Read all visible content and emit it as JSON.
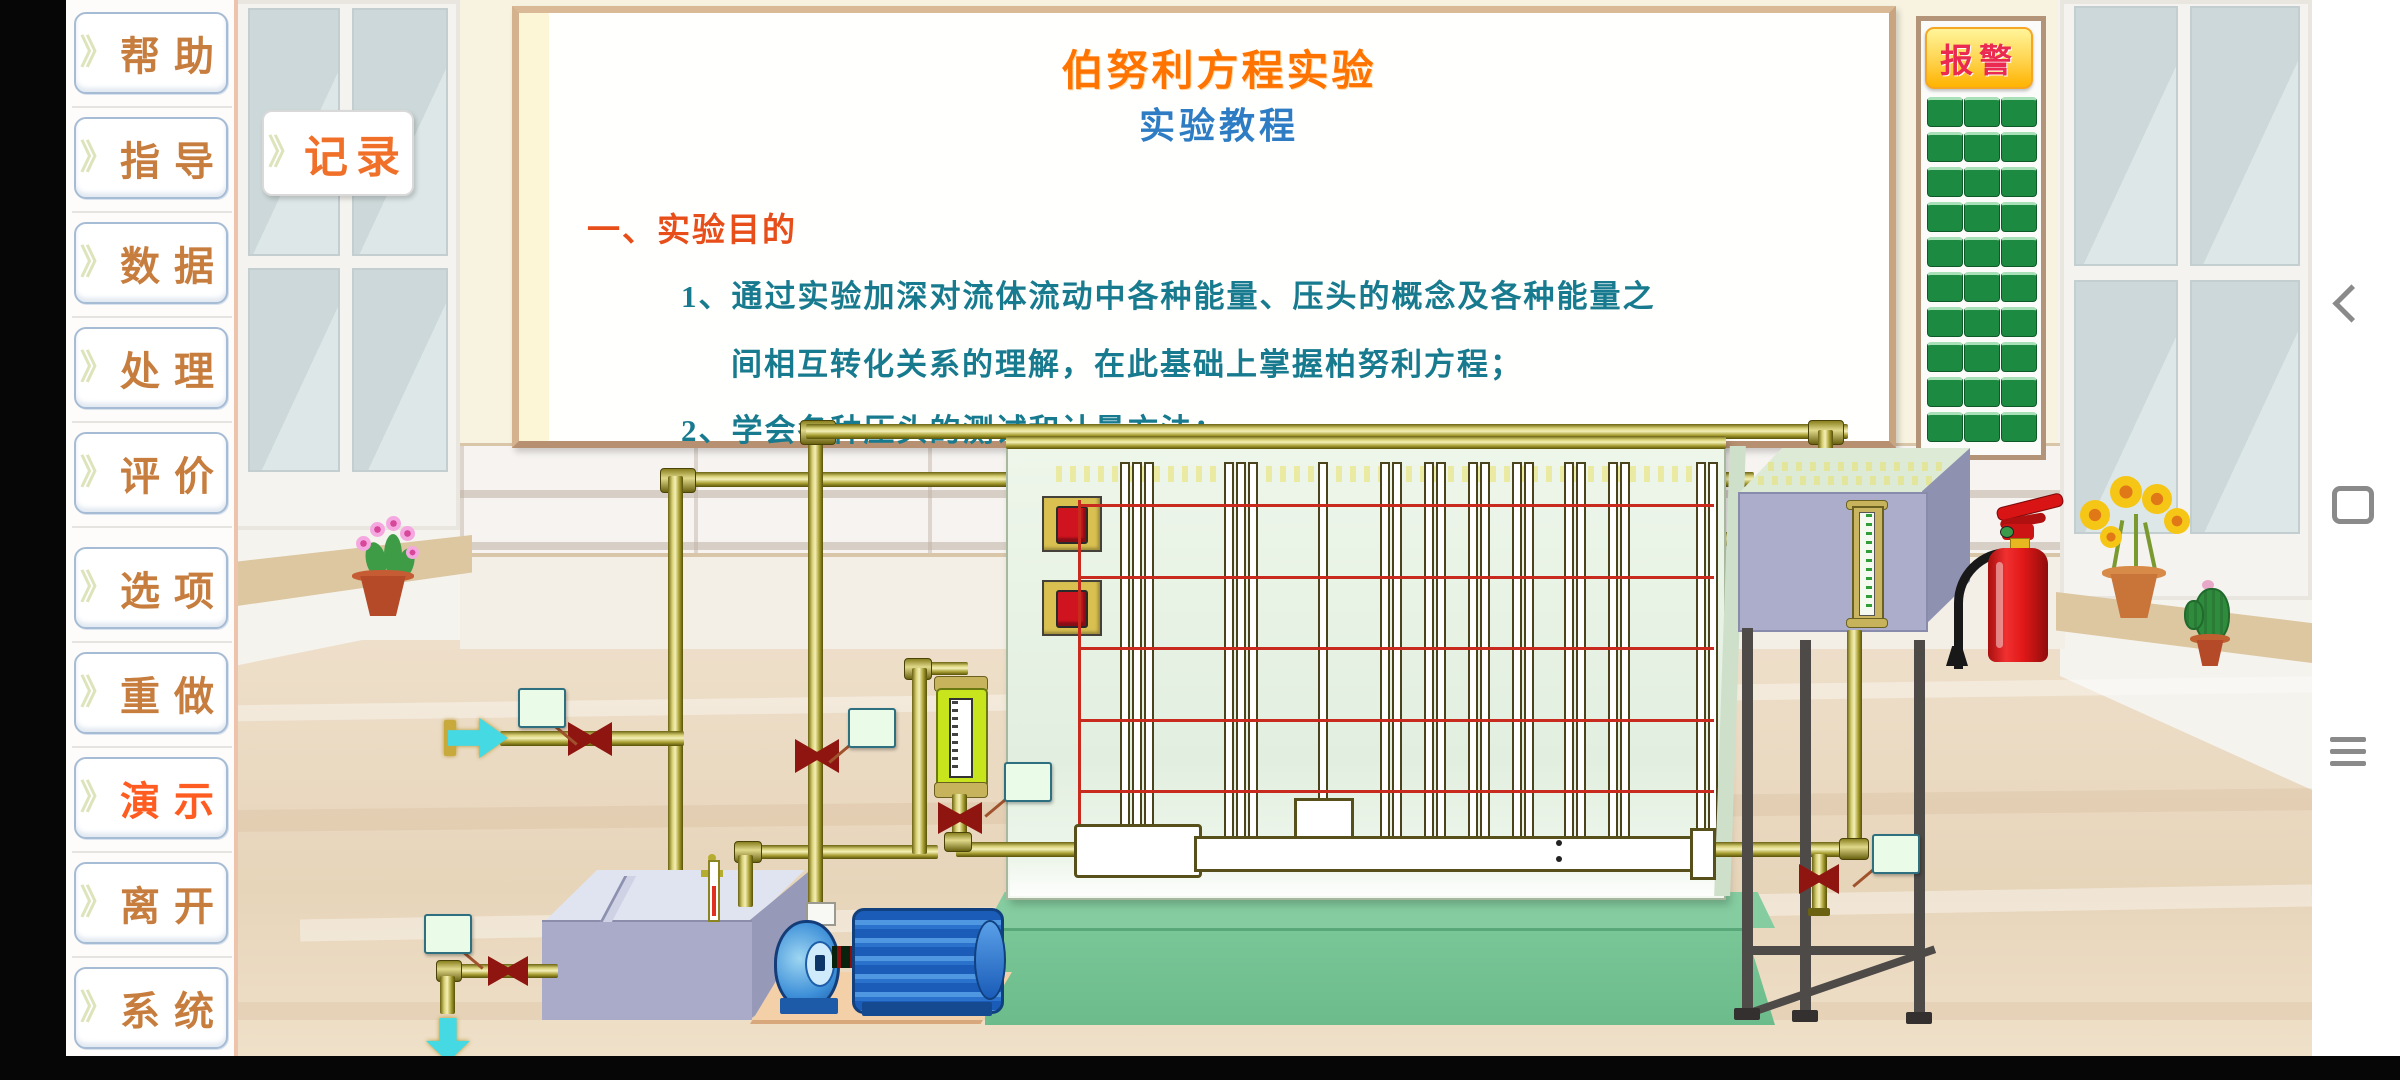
{
  "sidebar": {
    "items": [
      {
        "id": "help",
        "label": "帮助",
        "highlight": false
      },
      {
        "id": "guide",
        "label": "指导",
        "highlight": false
      },
      {
        "id": "data",
        "label": "数据",
        "highlight": false
      },
      {
        "id": "process",
        "label": "处理",
        "highlight": false
      },
      {
        "id": "evaluate",
        "label": "评价",
        "highlight": false
      },
      {
        "id": "options",
        "label": "选项",
        "highlight": false
      },
      {
        "id": "redo",
        "label": "重做",
        "highlight": false
      },
      {
        "id": "demo",
        "label": "演示",
        "highlight": true
      },
      {
        "id": "leave",
        "label": "离开",
        "highlight": false
      },
      {
        "id": "system",
        "label": "系统",
        "highlight": false
      }
    ],
    "chevron_glyph": "》"
  },
  "record_button": {
    "label": "记录"
  },
  "whiteboard": {
    "title": "伯努利方程实验",
    "subtitle": "实验教程",
    "section_heading": "一、实验目的",
    "lines": [
      "1、通过实验加深对流体流动中各种能量、压头的概念及各种能量之",
      "间相互转化关系的理解，在此基础上掌握柏努利方程；",
      "2、学会各种压头的测试和计量方法；"
    ]
  },
  "alarm_panel": {
    "label": "报警",
    "grid_rows": 10,
    "grid_cols": 3
  },
  "nav_bar": {
    "icons": [
      "back-icon",
      "home-icon",
      "menu-icon"
    ]
  },
  "colors": {
    "sidebar_text": "#c67d3e",
    "sidebar_active_text": "#fe5c20",
    "record_text": "#f0702a",
    "title_orange": "#ff7300",
    "subtitle_blue": "#2e7cc3",
    "heading_red": "#e84e1a",
    "body_teal": "#177a8e",
    "alarm_text": "#ea2a50",
    "alarm_button_green": "#1c8a40",
    "pipe_gold": "#a89e32",
    "valve_dark_red": "#8f1510",
    "manometer_board_mint": "#e7f2e6",
    "base_green": "#6fbf8f",
    "tank_lavender": "#a9abc9",
    "pump_blue": "#2a72cc",
    "arrow_cyan": "#45d9e4",
    "extinguisher_red": "#e21818"
  }
}
